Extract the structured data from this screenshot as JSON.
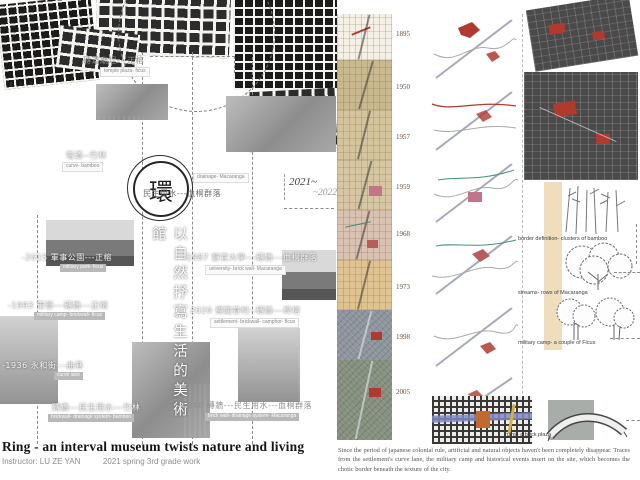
{
  "poster": {
    "ring_glyph": "環",
    "concept_vertical": "以自然抒寫生活的美術館",
    "period": {
      "start": "2021~",
      "end": "~2022"
    },
    "title": "Ring - an interval museum twists nature and living",
    "credits": {
      "instructor": "Instructor: LU ZE YAN",
      "work": "2021 spring 3rd grade work"
    },
    "description": "Since the period of japanese colonial rule, artificial and natural objects haven't been completely disappear. Traces from the settlement's curve lane, the military camp and historical events insert on the site, which becomes the chotic border beneath the texture of the city."
  },
  "timeline_labels": [
    {
      "zh": "磚道廟埕---正榕",
      "en": "temple plaza- ficus"
    },
    {
      "zh": "彎道--竹林",
      "en": "curve- bamboo"
    },
    {
      "zh": "民生用水---血桐群落",
      "en": "drainage- Macaranga"
    },
    {
      "zh": "-2015 軍事公園---正榕",
      "en": "military park- ficus"
    },
    {
      "zh": "-1987 靜宜大學---磚牆---血桐群落",
      "en": "university- brick wall- Macaranga"
    },
    {
      "zh": "-1993 軍營---磚牆---正榕",
      "en": "military camp- brickwall- ficus"
    },
    {
      "zh": "2020 模範眷村--磚牆---樟榕",
      "en": "settlement- brickwall- camphor- ficus"
    },
    {
      "zh": "-1936 永和街---曲巷",
      "en": "curve lane"
    },
    {
      "zh": "磚牆---民生用水---竹林",
      "en": "brickwall- drainage system- bamboo"
    },
    {
      "zh": "-1948 磚牆---民生用水---血桐群落",
      "en": "brick wall- drainage system- Macaranga"
    }
  ],
  "historic_maps": {
    "years": [
      "1895",
      "1950",
      "1957",
      "1959",
      "1968",
      "1973",
      "1998",
      "2005"
    ]
  },
  "site_analysis": {
    "notes": [
      "border definition- clusters of bamboo",
      "streams- rows of Macaranga",
      "military camp- a couple of Ficus",
      "ruins- a brick plaza"
    ]
  },
  "colors": {
    "accent_red": "#b03a2e",
    "map_tan": "#d3c49c",
    "aerial_gray": "#8e959d"
  }
}
